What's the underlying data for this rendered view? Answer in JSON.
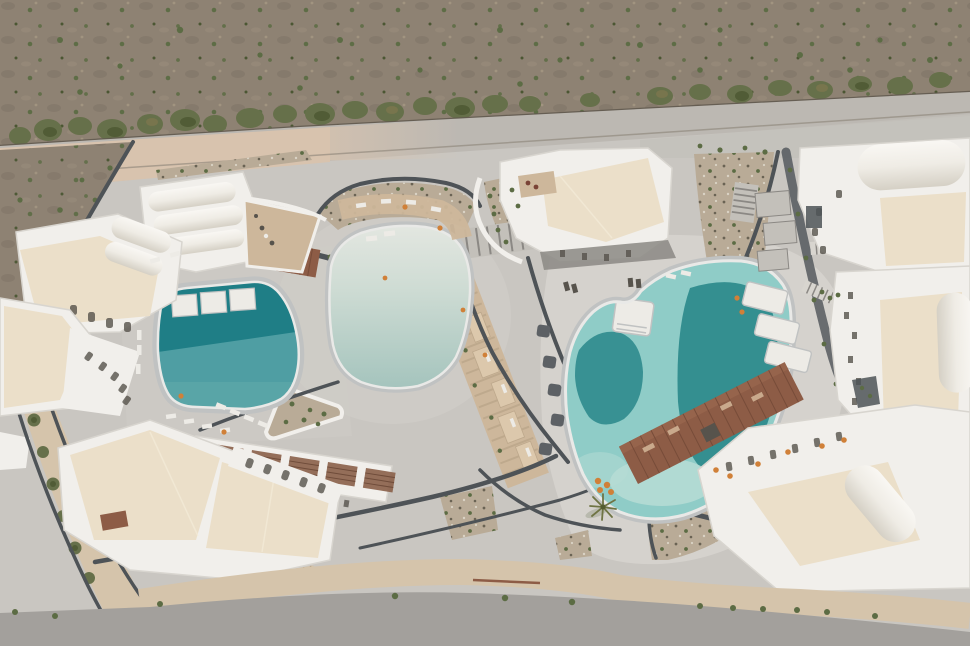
{
  "meta": {
    "title": "Aerial drone view of a white Cycladic resort complex with three freeform swimming pools, concrete plazas, planting beds and a scrubland field along the top",
    "view": "top-down aerial photograph"
  },
  "palette": {
    "field": "#8e8273",
    "field_patch": "#7a7062",
    "field_light": "#a89a85",
    "shrub": "#5c6c44",
    "shrub_dark": "#47542f",
    "tree": "#66704a",
    "tree_dark": "#515c36",
    "tree_rust": "#8a7a4f",
    "road_tan": "#d8c3ae",
    "road_gray": "#bcb8b2",
    "fence": "#5f584d",
    "guardrail": "#8a8276",
    "concrete": "#c9c6c1",
    "concrete_mid": "#cfccc7",
    "concrete_light": "#d7d4cf",
    "plaza_gray": "#c3c0ba",
    "wall": "#4e5357",
    "wall_light": "#8b8884",
    "white_wall": "#f1efeb",
    "white_bright": "#f8f6f2",
    "building_edge": "#d8d5cf",
    "roof_cream": "#ebdfc9",
    "roof_ridge": "#f4ebd9",
    "vault_hi": "#f9f7f3",
    "vault_mid": "#efece5",
    "vault_shade": "#d5d0c5",
    "pool_rim": "#c0c2c2",
    "pool_ledge": "#e9e9e7",
    "pool_teal_dark": "#1f7e86",
    "pool_teal": "#4f9ea3",
    "pool_teal_soft": "#63acac",
    "pool_pale_top": "#e4e7e1",
    "pool_pale_mid": "#cfdcd4",
    "pool_pale": "#a3c3bc",
    "pool_aqua": "#8fccc7",
    "pool_deep": "#2f8b8d",
    "pool_lagoon": "#b7dcd5",
    "deck_wood": "#8d5c46",
    "deck_plank": "#774c39",
    "deck_light": "#9d6950",
    "pergola_wood": "#8a5f49",
    "pergola_slat": "#6f4c3a",
    "gravel": "#b9ab97",
    "gravel_dot": "#6a6354",
    "gravel_white": "#dad3c5",
    "terrace_tan": "#cdb79b",
    "terrace_light": "#dcc8ac",
    "terrace_rung": "#bda88c",
    "lounger": "#edebe6",
    "lounger_tan": "#c9a98c",
    "umbrella_orange": "#d08038",
    "umbrella_dark": "#5d6165",
    "furniture_dark": "#57534c",
    "furniture_red": "#7a4336",
    "sidewalk": "#d5c4ab",
    "road_bottom": "#a3a09c",
    "palm": "#6f7444",
    "palm_dark": "#545c30"
  },
  "scene": {
    "regions": {
      "field": "scrubland field with shrubs and tree row",
      "road": "access road between field and resort",
      "grounds": "poured-concrete resort grounds",
      "west_pool": "square teal pool with three in-pool sun platforms",
      "central_pool": "pale beach-entry freeform pool",
      "east_pool": "large freeform pool with two deep teal zones and sun shelves",
      "terrace_band": "stepped tan sunbed terraces between walls",
      "deck": "long timber sun deck beside east pool",
      "buildings": "white vaulted-roof guest buildings with cream rooftops",
      "planting": "gravel beds with green shrubs",
      "bottom_road": "asphalt road along bottom edge"
    },
    "pool_count": 3
  }
}
